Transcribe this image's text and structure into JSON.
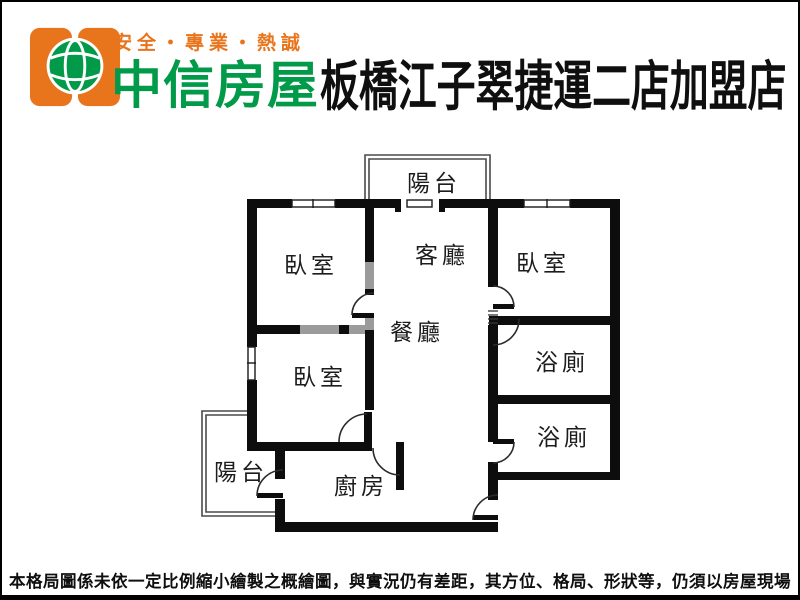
{
  "header": {
    "tagline": "安全・專業・熱誠",
    "brand": "中信房屋",
    "store_title": "板橋江子翠捷運二店加盟店"
  },
  "floorplan": {
    "rooms": {
      "balcony_top": "陽台",
      "bedroom_top_left": "臥室",
      "living_room": "客廳",
      "bedroom_top_right": "臥室",
      "dining_room": "餐廳",
      "bedroom_mid_left": "臥室",
      "bath_upper": "浴廁",
      "bath_lower": "浴廁",
      "balcony_bottom": "陽台",
      "kitchen": "廚房"
    }
  },
  "footer": {
    "disclaimer": "本格局圖係未依一定比例縮小繪製之概繪圖，與實況仍有差距，其方位、格局、形狀等，仍須以房屋現場為準。"
  },
  "colors": {
    "brand_orange": "#e8741c",
    "brand_green": "#009a49",
    "wall_black": "#0d0d0d",
    "wall_gray": "#9b9b9b"
  }
}
